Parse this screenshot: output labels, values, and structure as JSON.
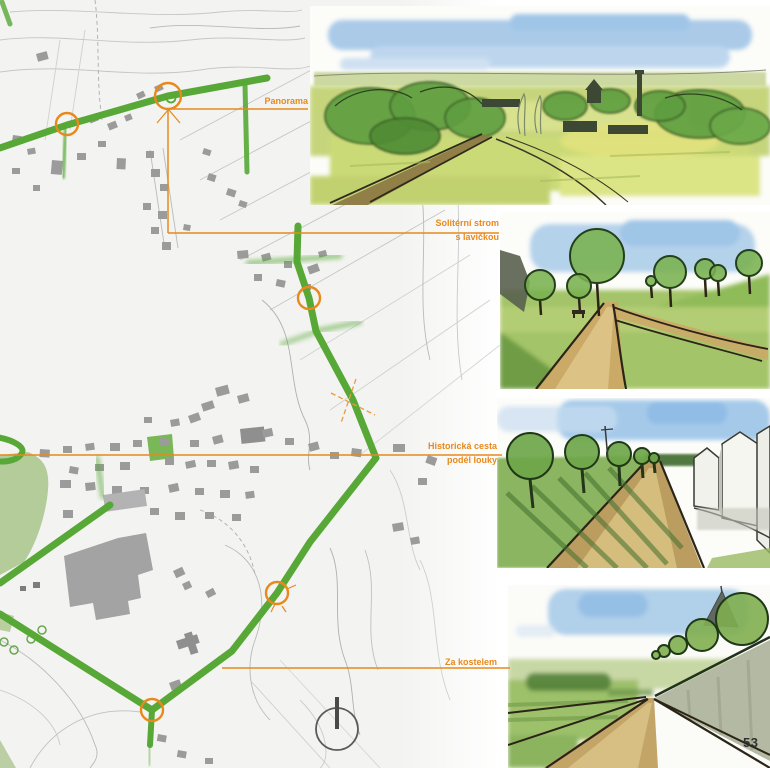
{
  "page": {
    "number": "53"
  },
  "colors": {
    "route_green": "#57a836",
    "annotation_orange": "#e8891c",
    "building_gray": "#9b9b9b",
    "park_green": "#b3cc9a",
    "contour_gray": "#c6c6c6",
    "sky_blue": "#a9cbe9",
    "path_tan": "#c3a568"
  },
  "map": {
    "name": "village-route-map",
    "annotations": [
      {
        "id": "panorama",
        "line1": "Panorama",
        "line2": ""
      },
      {
        "id": "soliterni-strom",
        "line1": "Solitérní strom",
        "line2": "s lavičkou"
      },
      {
        "id": "historicka-cesta",
        "line1": "Historická cesta",
        "line2": "podél louky"
      },
      {
        "id": "za-kostelem",
        "line1": "Za kostelem",
        "line2": ""
      }
    ],
    "markers": [
      {
        "name": "route-marker-west",
        "x": 67,
        "y": 124
      },
      {
        "name": "route-marker-panorama-tree",
        "x": 168,
        "y": 96
      },
      {
        "name": "route-marker-north-path",
        "x": 309,
        "y": 298
      },
      {
        "name": "route-marker-meadow-path",
        "x": 277,
        "y": 593
      },
      {
        "name": "route-marker-behind-church",
        "x": 152,
        "y": 710
      }
    ]
  },
  "sketches": [
    {
      "name": "panorama-sketch"
    },
    {
      "name": "solitary-tree-sketch"
    },
    {
      "name": "historic-path-sketch"
    },
    {
      "name": "behind-church-sketch"
    }
  ]
}
